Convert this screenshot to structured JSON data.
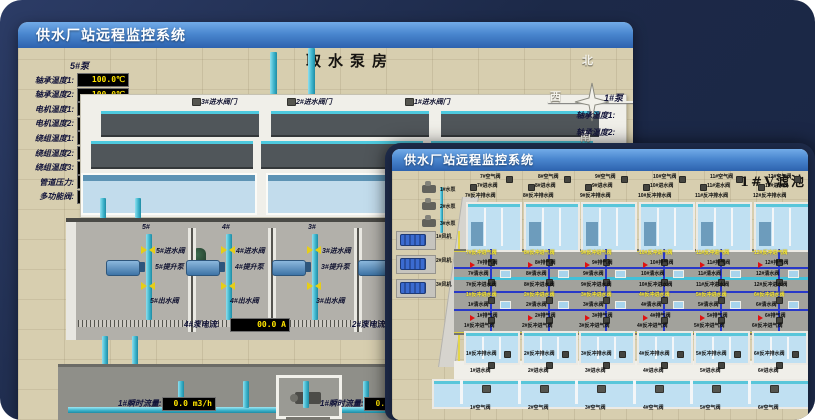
{
  "back_window": {
    "title": "供水厂站远程监控系统",
    "scene_title": "取水泵房",
    "pump_panel": {
      "header": "5#泵",
      "rows": [
        {
          "label": "轴承温度1:",
          "value": "100.0℃"
        },
        {
          "label": "轴承温度2:",
          "value": "100.0℃"
        },
        {
          "label": "电机温度1:",
          "value": "18.1℃"
        },
        {
          "label": "电机温度2:",
          "value": "17.9℃"
        },
        {
          "label": "绕组温度1:",
          "value": "18.0℃"
        },
        {
          "label": "绕组温度2:",
          "value": "18.1℃"
        },
        {
          "label": "绕组温度3:",
          "value": "18.1℃"
        },
        {
          "label": "管道压力:",
          "value": "0.0007MPa"
        },
        {
          "label": "多功能阀:",
          "value": "0%"
        }
      ]
    },
    "right_panel": {
      "header": "1#泵",
      "labels": [
        "轴承温度1:",
        "轴承温度2:"
      ]
    },
    "compass": {
      "north": "北",
      "west": "西",
      "south": "南"
    },
    "inlet_valves": [
      "3#进水阀门",
      "2#进水阀门",
      "1#进水阀门"
    ],
    "bays": [
      {
        "no": "5#",
        "inlet": "5#进水阀",
        "pump": "5#提升泵",
        "outlet": "5#出水阀"
      },
      {
        "no": "4#",
        "inlet": "4#进水阀",
        "pump": "4#提升泵",
        "outlet": "4#出水阀"
      },
      {
        "no": "3#",
        "inlet": "3#进水阀",
        "pump": "3#提升泵",
        "outlet": "3#出水阀"
      },
      {
        "no": "2#",
        "inlet": "2#进水阀",
        "pump": "2#提升泵",
        "outlet": "2#出水阀"
      }
    ],
    "current_meters": [
      {
        "label": "4#泵电流:",
        "value": "00.0 A"
      },
      {
        "label": "2#泵电流:",
        "value": ""
      }
    ],
    "flow_meters": [
      {
        "label": "1#瞬时流量:",
        "value": "0.0 m3/h"
      },
      {
        "label": "1#瞬时流量:",
        "value": "0.0 m3/h"
      }
    ]
  },
  "front_window": {
    "title": "供水厂站远程监控系统",
    "scene_title": "1#V滤池",
    "pumps": [
      "1#水泵",
      "2#水泵",
      "3#水泵"
    ],
    "blowers": [
      "1#风机",
      "2#风机",
      "3#风机"
    ],
    "top_filters": [
      {
        "air": "7#空气阀",
        "inlet": "7#进水阀",
        "backwash_drain": "7#反冲排水阀",
        "backwash_air": "7#反冲进气阀",
        "exhaust": "7#排气阀",
        "clean": "7#清水阀",
        "backwash_water": "7#反冲进水阀"
      },
      {
        "air": "8#空气阀",
        "inlet": "8#进水阀",
        "backwash_drain": "8#反冲排水阀",
        "backwash_air": "8#反冲进气阀",
        "exhaust": "8#排气阀",
        "clean": "8#清水阀",
        "backwash_water": "8#反冲进水阀"
      },
      {
        "air": "9#空气阀",
        "inlet": "9#进水阀",
        "backwash_drain": "9#反冲排水阀",
        "backwash_air": "9#反冲进气阀",
        "exhaust": "9#排气阀",
        "clean": "9#清水阀",
        "backwash_water": "9#反冲进水阀"
      },
      {
        "air": "10#空气阀",
        "inlet": "10#进水阀",
        "backwash_drain": "10#反冲排水阀",
        "backwash_air": "10#反冲进气阀",
        "exhaust": "10#排气阀",
        "clean": "10#清水阀",
        "backwash_water": "10#反冲进水阀"
      },
      {
        "air": "11#空气阀",
        "inlet": "11#进水阀",
        "backwash_drain": "11#反冲排水阀",
        "backwash_air": "11#反冲进气阀",
        "exhaust": "11#排气阀",
        "clean": "11#清水阀",
        "backwash_water": "11#反冲进水阀"
      },
      {
        "air": "12#空气阀",
        "inlet": "12#进水阀",
        "backwash_drain": "12#反冲排水阀",
        "backwash_air": "12#反冲进气阀",
        "exhaust": "12#排气阀",
        "clean": "12#清水阀",
        "backwash_water": "12#反冲进水阀"
      }
    ],
    "bottom_filters": [
      {
        "backwash_water": "1#反冲进水阀",
        "clean": "1#清水阀",
        "exhaust": "1#排气阀",
        "backwash_air": "1#反冲进气阀",
        "backwash_drain": "1#反冲排水阀",
        "inlet": "1#进水阀",
        "air": "1#空气阀"
      },
      {
        "backwash_water": "2#反冲进水阀",
        "clean": "2#清水阀",
        "exhaust": "2#排气阀",
        "backwash_air": "2#反冲进气阀",
        "backwash_drain": "2#反冲排水阀",
        "inlet": "2#进水阀",
        "air": "2#空气阀"
      },
      {
        "backwash_water": "3#反冲进水阀",
        "clean": "3#清水阀",
        "exhaust": "3#排气阀",
        "backwash_air": "3#反冲进气阀",
        "backwash_drain": "3#反冲排水阀",
        "inlet": "3#进水阀",
        "air": "3#空气阀"
      },
      {
        "backwash_water": "4#反冲进水阀",
        "clean": "4#清水阀",
        "exhaust": "4#排气阀",
        "backwash_air": "4#反冲进气阀",
        "backwash_drain": "4#反冲排水阀",
        "inlet": "4#进水阀",
        "air": "4#空气阀"
      },
      {
        "backwash_water": "5#反冲进水阀",
        "clean": "5#清水阀",
        "exhaust": "5#排气阀",
        "backwash_air": "5#反冲进气阀",
        "backwash_drain": "5#反冲排水阀",
        "inlet": "5#进水阀",
        "air": "5#空气阀"
      },
      {
        "backwash_water": "6#反冲进水阀",
        "clean": "6#清水阀",
        "exhaust": "6#排气阀",
        "backwash_air": "6#反冲进气阀",
        "backwash_drain": "6#反冲排水阀",
        "inlet": "6#进水阀",
        "air": "6#空气阀"
      }
    ]
  }
}
